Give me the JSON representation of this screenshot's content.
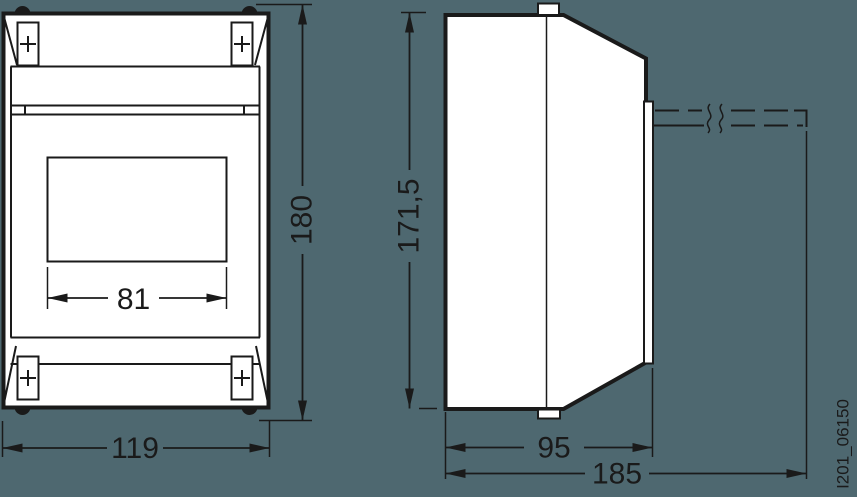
{
  "drawing_code": "I201_06150",
  "colors": {
    "background": "#4E6870",
    "line": "#1A1A1A",
    "fill": "#FFFFFF"
  },
  "dimensions": {
    "front_width": "119",
    "front_height": "180",
    "window_width": "81",
    "side_height": "171,5",
    "side_depth_body": "95",
    "side_depth_total": "185"
  }
}
